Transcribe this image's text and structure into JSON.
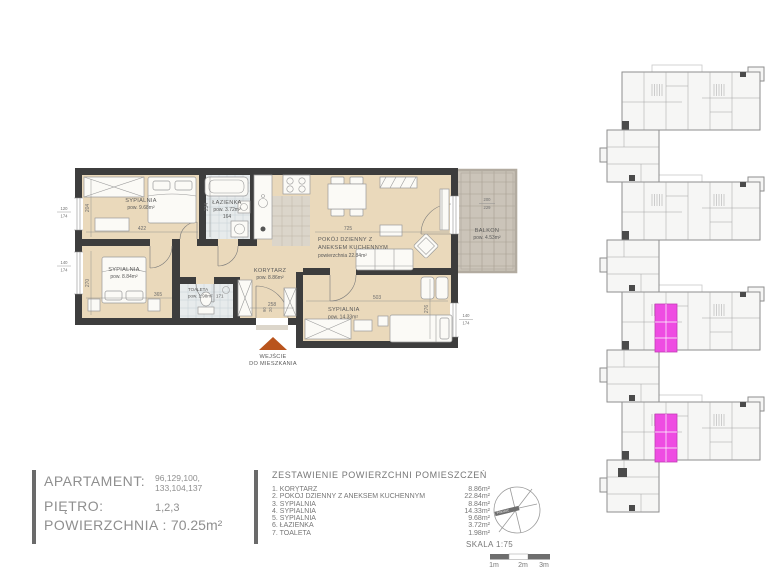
{
  "colors": {
    "floor": "#ead9bb",
    "wall": "#3d3d3d",
    "tile": "#e7ebec",
    "tile-line": "#c6d0d4",
    "kitchen-tile": "#dbd5ca",
    "kitchen-line": "#bdb5a6",
    "balcony-tile": "#cbc4b9",
    "balcony-line": "#a89f92",
    "furniture": "#fbfaf6",
    "furniture-line": "#9a9a9a",
    "highlight": "#ee4ce2",
    "entrance": "#b9541d",
    "text": "#5a5a5a",
    "dim": "#6f6f6f",
    "panel-text": "#8f8f8f",
    "keyplan-line": "#8e8e8e",
    "dark": "#4b4b4b"
  },
  "plan": {
    "rooms": {
      "bedroom1": {
        "name": "SYPIALNIA",
        "area": "pow. 9.68m²"
      },
      "bathroom": {
        "name": "ŁAZIENKA",
        "area": "pow. 3.72m²",
        "dim": "164"
      },
      "living": {
        "name1": "POKÓJ DZIENNY Z",
        "name2": "ANEKSEM KUCHENNYM",
        "area": "powierzchnia 22.84m²"
      },
      "balcony": {
        "name": "BALKON",
        "area": "pow. 4.53m²",
        "dim_top": "200",
        "dim_bottom": "229"
      },
      "bedroom2": {
        "name": "SYPIALNIA",
        "area": "pow. 8.84m²"
      },
      "toilet": {
        "name": "TOALETA",
        "area": "pow. 1.98m²",
        "dim": "171"
      },
      "corridor": {
        "name": "KORYTARZ",
        "area": "pow. 8.86m²"
      },
      "bedroom3": {
        "name": "SYPIALNIA",
        "area": "pow. 14.33m²"
      }
    },
    "dims": {
      "bedroom1_w": "422",
      "bedroom1_h": "204",
      "window1_a": "120",
      "window1_b": "174",
      "window2_a": "140",
      "window2_b": "174",
      "window3_a": "140",
      "window3_b": "174",
      "bathroom_h": "234",
      "living_w": "725",
      "bedroom2_w": "365",
      "bedroom2_h": "270",
      "bedroom3_w": "503",
      "bedroom3_h": "276",
      "corridor_w": "258",
      "door_a": "90",
      "door_b": "20"
    },
    "entrance": {
      "line1": "WEJŚCIE",
      "line2": "DO MIESZKANIA"
    }
  },
  "info_panel": {
    "apartment_label": "APARTAMENT:",
    "apartment_value1": "96,129,100,",
    "apartment_value2": "133,104,137",
    "floor_label": "PIĘTRO:",
    "floor_value": "1,2,3",
    "area_label": "POWIERZCHNIA :",
    "area_value": "70.25m²"
  },
  "area_table": {
    "title": "ZESTAWIENIE POWIERZCHNI  POMIESZCZEŃ",
    "rows": [
      {
        "name": "1. KORYTARZ",
        "value": "8.86m²"
      },
      {
        "name": "2. POKÓJ DZIENNY Z ANEKSEM KUCHENNYM",
        "value": "22.84m²"
      },
      {
        "name": "3. SYPIALNIA",
        "value": "8.84m²"
      },
      {
        "name": "4. SYPIALNIA",
        "value": "14.33m²"
      },
      {
        "name": "5. SYPIALNIA",
        "value": "9.68m²"
      },
      {
        "name": "6. ŁAZIENKA",
        "value": "3.72m²"
      },
      {
        "name": "7. TOALETA",
        "value": "1.98m²"
      }
    ]
  },
  "scale": {
    "label": "SKALA 1:75",
    "marks": [
      "1m",
      "2m",
      "3m"
    ]
  },
  "compass": {
    "label": "PÓŁNOC"
  }
}
